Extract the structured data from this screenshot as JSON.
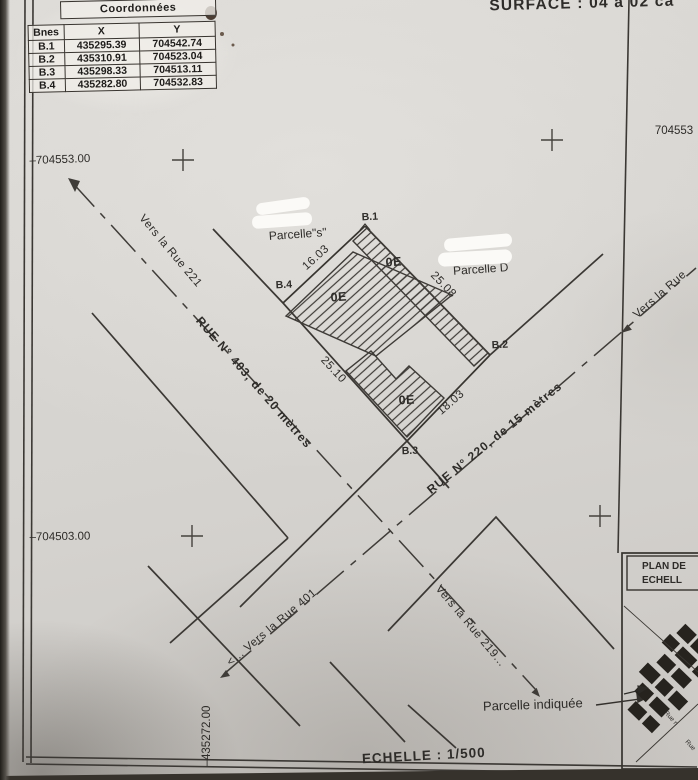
{
  "header": {
    "surface": "SURFACE : 04 a 02 ca",
    "grid_easting_right": "704553"
  },
  "coordinates_table": {
    "title": "Coordonnées",
    "columns": [
      "Bnes",
      "X",
      "Y"
    ],
    "rows": [
      [
        "B.1",
        "435295.39",
        "704542.74"
      ],
      [
        "B.2",
        "435310.91",
        "704523.04"
      ],
      [
        "B.3",
        "435298.33",
        "704513.11"
      ],
      [
        "B.4",
        "435282.80",
        "704532.83"
      ]
    ]
  },
  "grid": {
    "north_left": "–704553.00",
    "south_left": "–704503.00",
    "west_bottom": "–435272.00"
  },
  "plan": {
    "parcel_s": "Parcelle\"s\"",
    "parcel_d": "Parcelle D",
    "corner_b1": "B.1",
    "corner_b2": "B.2",
    "corner_b3": "B.3",
    "corner_b4": "B.4",
    "dim_b4_b1": "16.03",
    "dim_b1_b2": "25.08",
    "dim_b4_b3": "25.10",
    "dim_b3_b2": "18.03",
    "building_code": "0E",
    "street_403": "RUE N° 403, de 20 mètres",
    "street_220": "RUE N° 220, de 15 mètres",
    "dir_rue_221": "Vers la Rue 221",
    "dir_rue_401": "<... Vers la Rue 401",
    "dir_rue_219": "Vers la Rue 219...",
    "dir_rue_right": "Vers la Rue"
  },
  "footer": {
    "parcelle_indiquee": "Parcelle indiquée",
    "echelle": "ECHELLE : 1/500"
  },
  "inset": {
    "title_line1": "PLAN DE",
    "title_line2": "ECHELL",
    "rue_label_1": "Rue n",
    "rue_label_2": "Rue"
  },
  "colors": {
    "paper": "#d8d6d2",
    "ink": "#33312e",
    "whiteout": "#fbfaf7"
  }
}
